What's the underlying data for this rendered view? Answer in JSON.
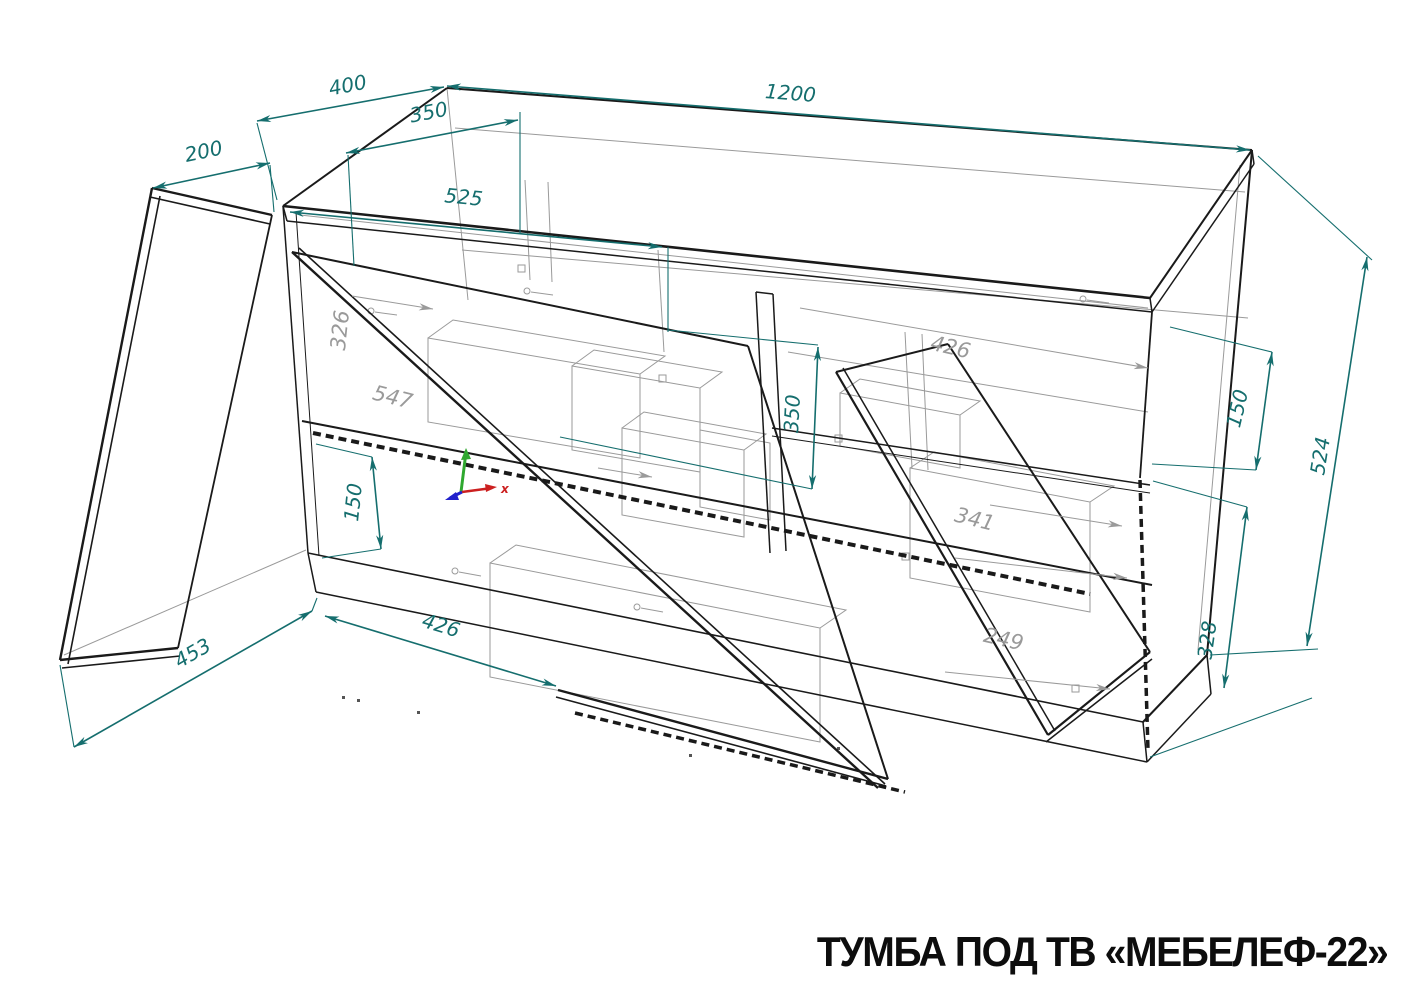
{
  "title": "ТУМБА ПОД ТВ «МЕБЕЛЕФ-22»",
  "drawing": {
    "kind": "CAD isometric assembly wireframe of TV stand with open doors",
    "units": "mm",
    "dims": {
      "door_depth_200": "200",
      "top_depth_400": "400",
      "inner_depth_350": "350",
      "width_1200": "1200",
      "top_diagonal_525": "525",
      "left_section_150": "150",
      "middle_opening_350": "350",
      "door_diagonal_453": "453",
      "flap_width_426": "426",
      "right_top_150": "150",
      "height_524": "524",
      "right_bottom_328": "328",
      "gray_side_326": "326",
      "gray_inner_547": "547",
      "gray_shelf_426": "426",
      "gray_drawer_341": "341",
      "gray_drawer_249": "249"
    },
    "axis": {
      "x_label": "x"
    }
  },
  "colors": {
    "dimension": "#156e6e",
    "outline": "#1a1a1a",
    "secondary": "#9a9a9a",
    "background": "#ffffff",
    "axis_x": "#cc2020",
    "axis_y": "#2fa82f",
    "axis_z": "#2222cc"
  }
}
